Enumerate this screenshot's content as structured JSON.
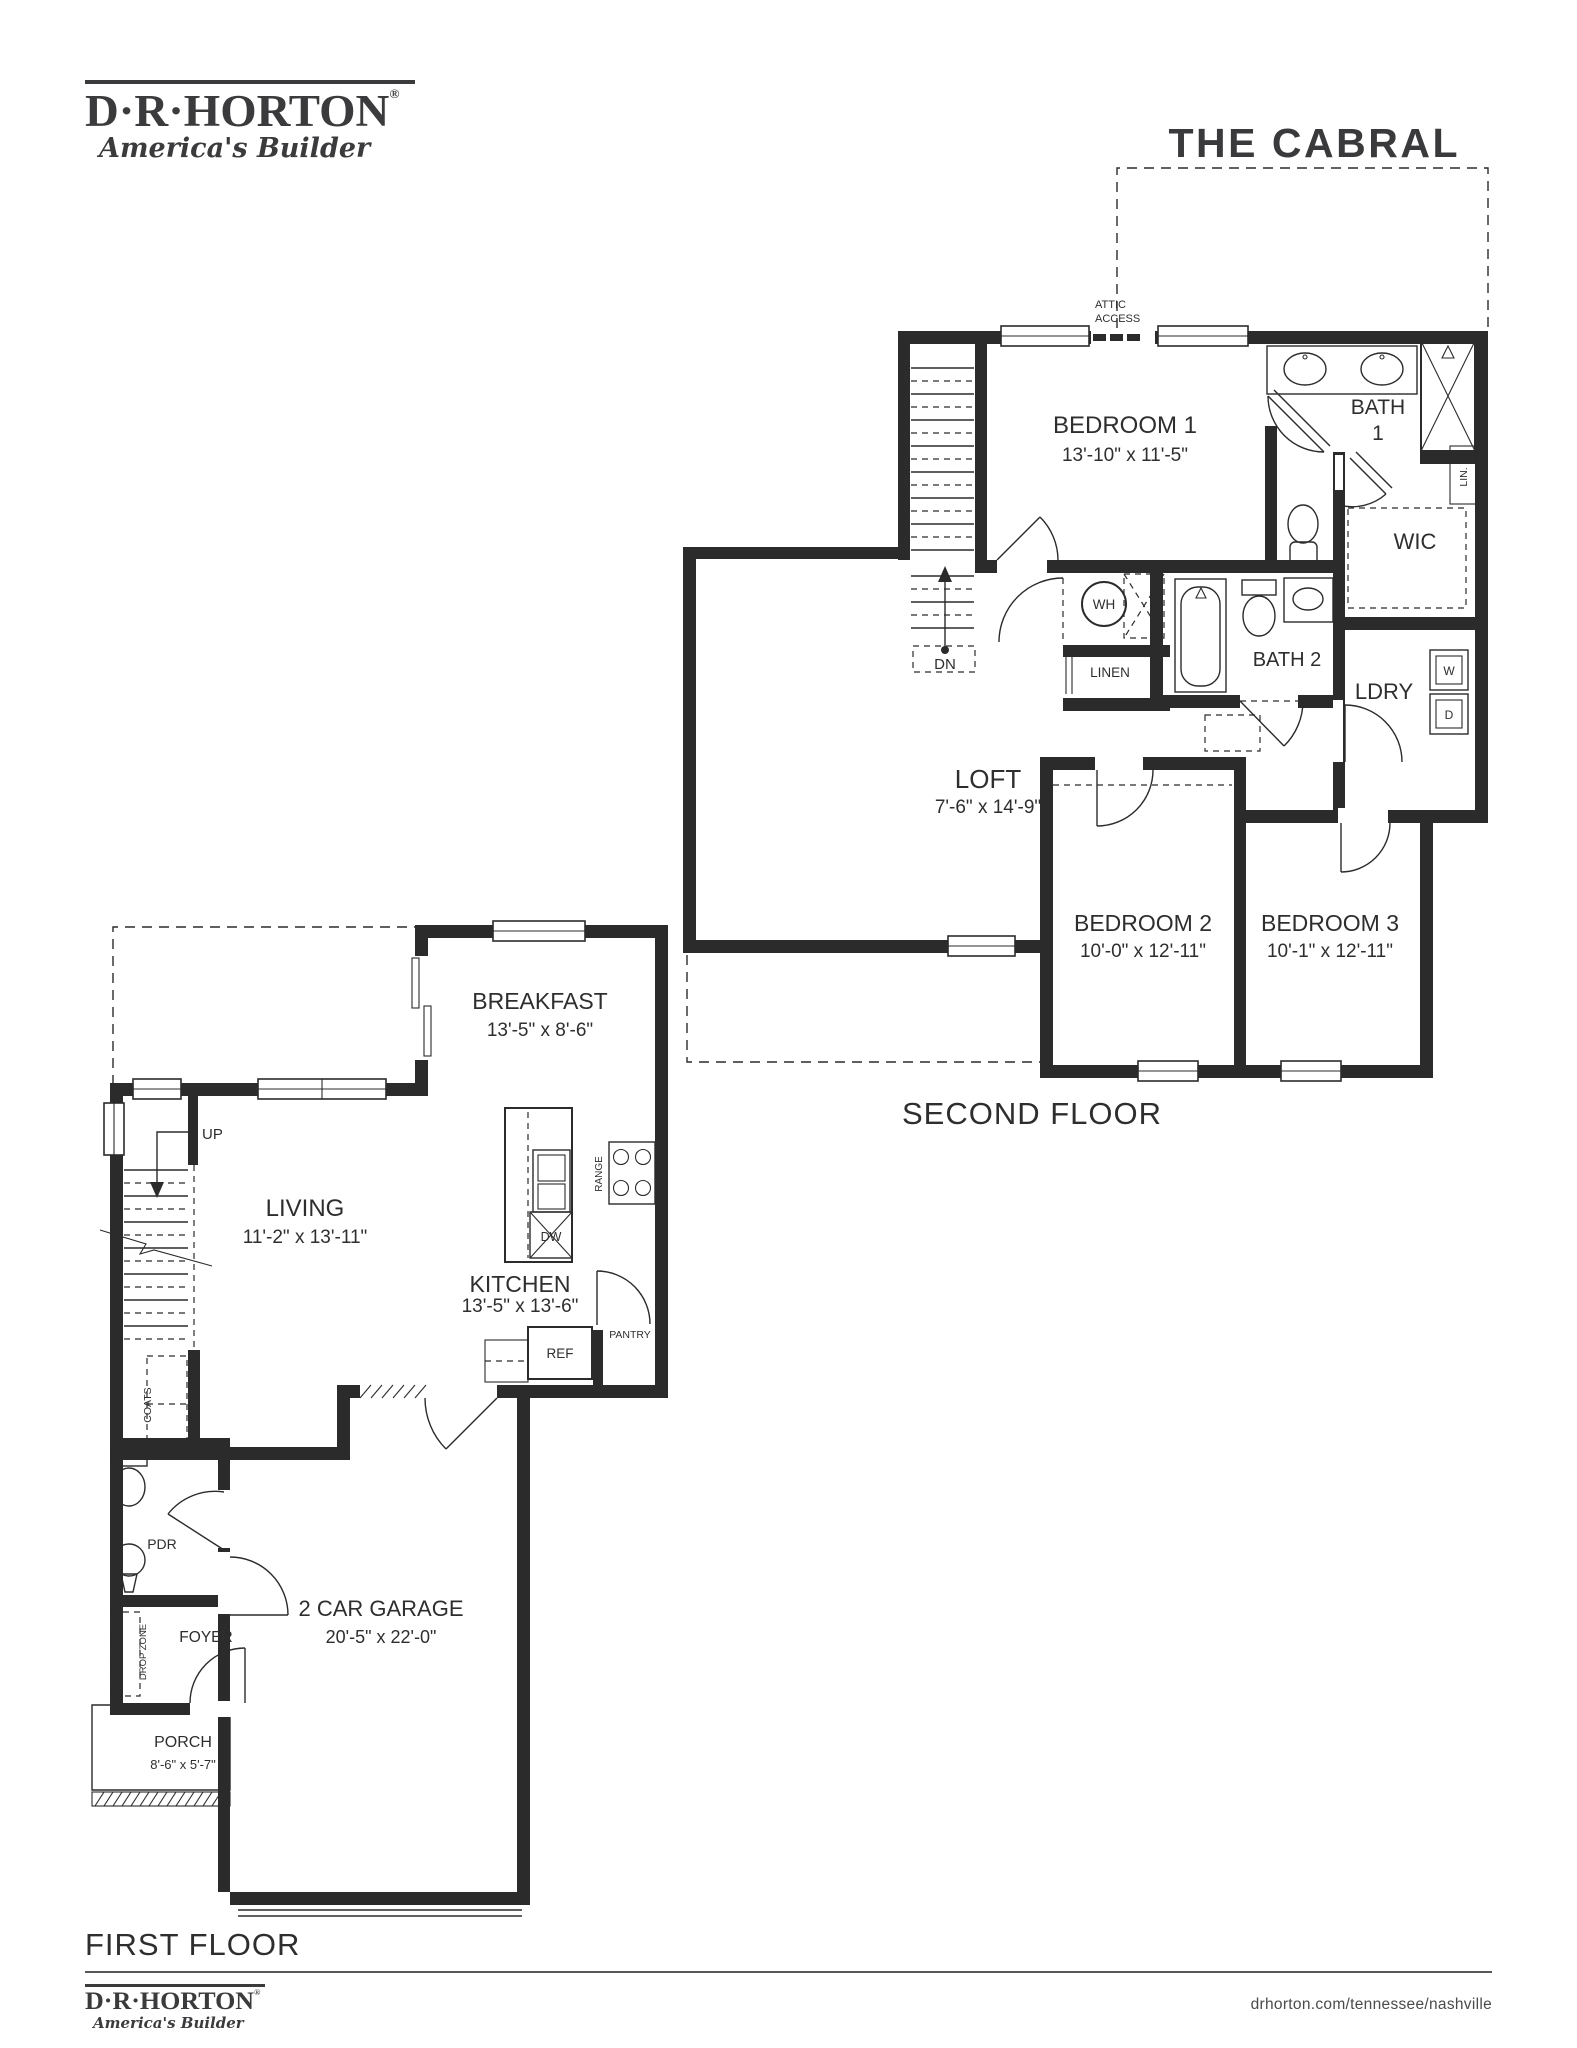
{
  "header": {
    "logo_name": "D·R·HORTON",
    "logo_reg": "®",
    "logo_tagline": "America's Builder",
    "plan_title": "THE CABRAL"
  },
  "second_floor": {
    "label": "SECOND FLOOR",
    "attic_line1": "ATTIC",
    "attic_line2": "ACCESS",
    "bedroom1_name": "BEDROOM 1",
    "bedroom1_dims": "13'-10\" x 11'-5\"",
    "bath1_line1": "BATH",
    "bath1_line2": "1",
    "wic": "WIC",
    "lin": "LIN.",
    "wh": "WH",
    "linen": "LINEN",
    "bath2": "BATH 2",
    "ldry": "LDRY",
    "washer": "W",
    "dryer": "D",
    "dn": "DN",
    "loft_name": "LOFT",
    "loft_dims": "7'-6\" x 14'-9\"",
    "bedroom2_name": "BEDROOM 2",
    "bedroom2_dims": "10'-0\" x 12'-11\"",
    "bedroom3_name": "BEDROOM 3",
    "bedroom3_dims": "10'-1\" x 12'-11\""
  },
  "first_floor": {
    "label": "FIRST FLOOR",
    "breakfast_name": "BREAKFAST",
    "breakfast_dims": "13'-5\" x 8'-6\"",
    "living_name": "LIVING",
    "living_dims": "11'-2\" x 13'-11\"",
    "kitchen_name": "KITCHEN",
    "kitchen_dims": "13'-5\" x 13'-6\"",
    "up": "UP",
    "dw": "DW",
    "range": "RANGE",
    "ref": "REF",
    "pantry": "PANTRY",
    "coats": "COATS",
    "pdr": "PDR",
    "foyer": "FOYER",
    "drop_zone": "DROP ZONE",
    "porch_name": "PORCH",
    "porch_dims": "8'-6\" x 5'-7\"",
    "garage_name": "2 CAR GARAGE",
    "garage_dims": "20'-5\" x 22'-0\""
  },
  "footer": {
    "url": "drhorton.com/tennessee/nashville"
  }
}
